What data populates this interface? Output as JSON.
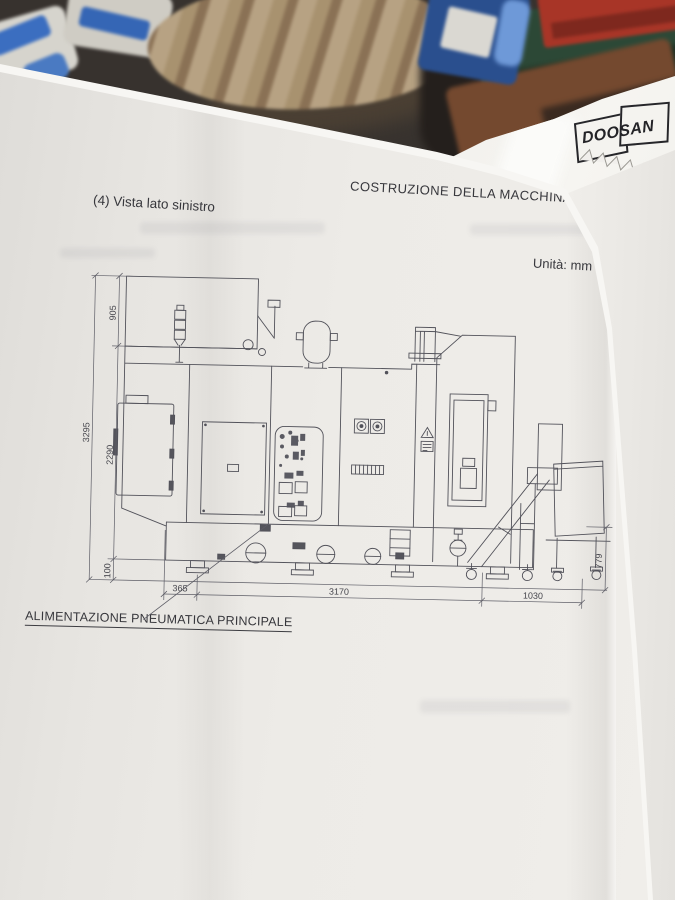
{
  "page": {
    "section_caption": "(4) Vista lato sinistro",
    "header": "COSTRUZIONE DELLA MACCHINA B-5",
    "units_label": "Unità: mm",
    "pneumatic_annotation": "ALIMENTAZIONE PNEUMATICA PRINCIPALE"
  },
  "logo": {
    "text": "DOOSAN"
  },
  "drawing": {
    "dims": {
      "overall_height": "3295",
      "upper_height": "905",
      "mid_height": "2290",
      "base_height": "100",
      "front_offset": "365",
      "body_length": "3170",
      "conveyor_length": "1030",
      "cart_height": "779"
    }
  },
  "colors": {
    "paper": "#eceae6",
    "ink": "#52525a",
    "clutter_red": "#a83527",
    "clutter_green": "#2c4836",
    "clutter_blue": "#2a4f8e"
  }
}
